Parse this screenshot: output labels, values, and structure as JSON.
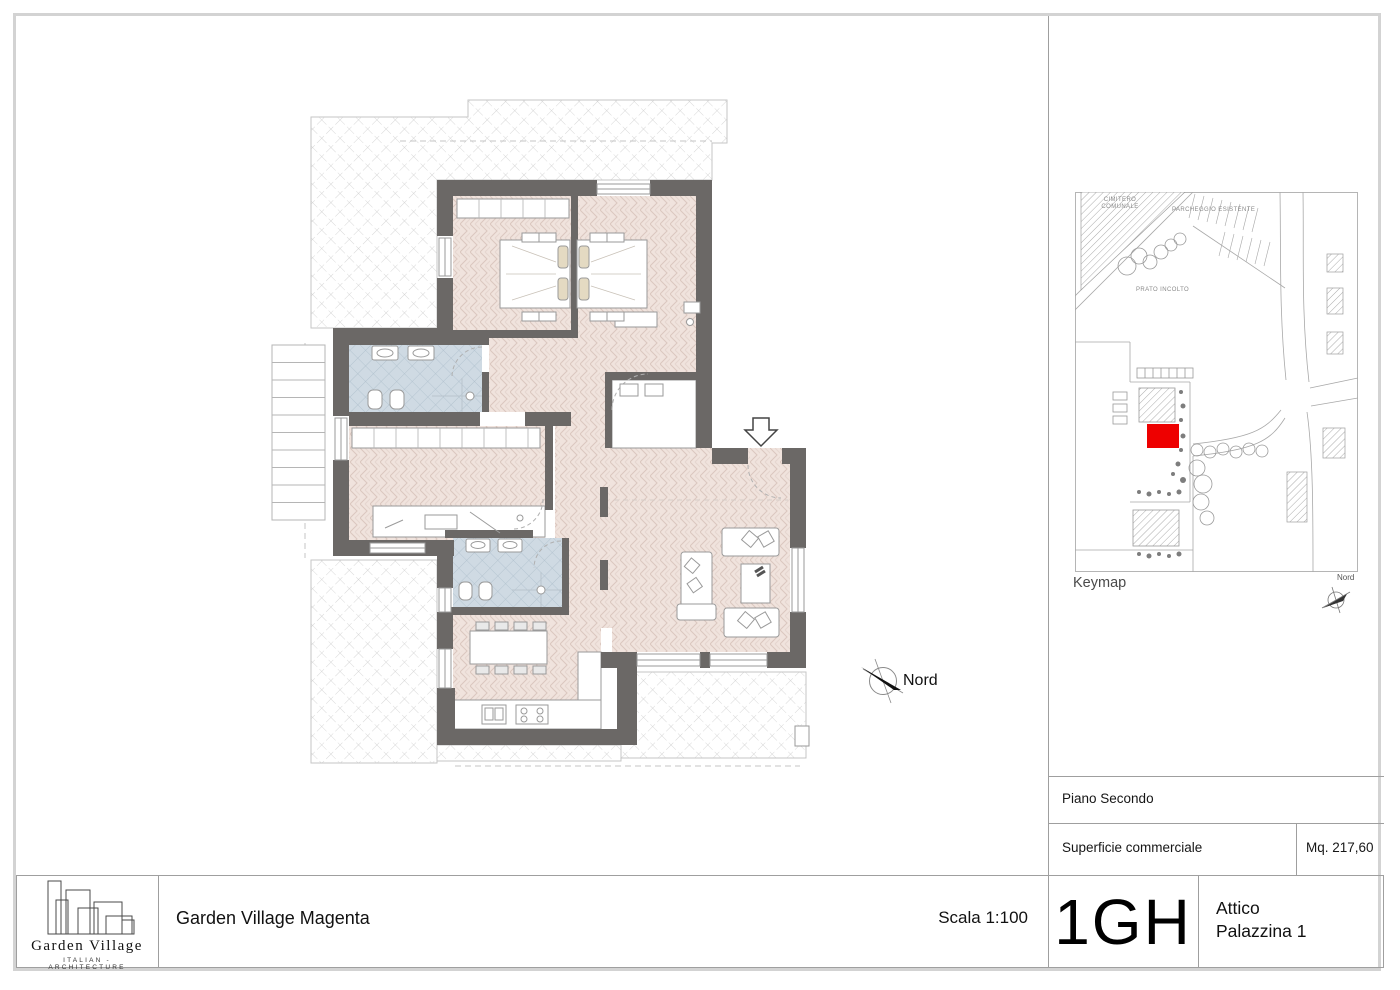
{
  "titleblock": {
    "project_title": "Garden Village Magenta",
    "scale_label": "Scala 1:100",
    "logo": {
      "name": "Garden Village",
      "tagline": "ITALIAN - ARCHITECTURE"
    }
  },
  "plan": {
    "north_label": "Nord"
  },
  "sidebar": {
    "keymap": {
      "caption": "Keymap",
      "north_label": "Nord",
      "labels": {
        "cemetery_line1": "CIMITERO",
        "cemetery_line2": "COMUNALE",
        "parking": "PARCHEGGIO ESISTENTE",
        "meadow": "PRATO INCOLTO"
      }
    },
    "floor_row": {
      "label": "Piano Secondo"
    },
    "area_row": {
      "label": "Superficie commerciale",
      "value": "Mq. 217,60"
    },
    "unit_row": {
      "code": "1GH",
      "name_line1": "Attico",
      "name_line2": "Palazzina 1"
    }
  },
  "colors": {
    "wall": "#6b6866",
    "floor": "#f0e3dd",
    "floor_line": "#dbc7bf",
    "bath_tile": "#cfdae3",
    "bath_tile_line": "#adbecb",
    "terrace_line": "#cdcdcd",
    "unit_marker_red": "#ee0000",
    "frame_gray": "#d3d3d3",
    "thin_line_gray": "#9f9f9f"
  }
}
